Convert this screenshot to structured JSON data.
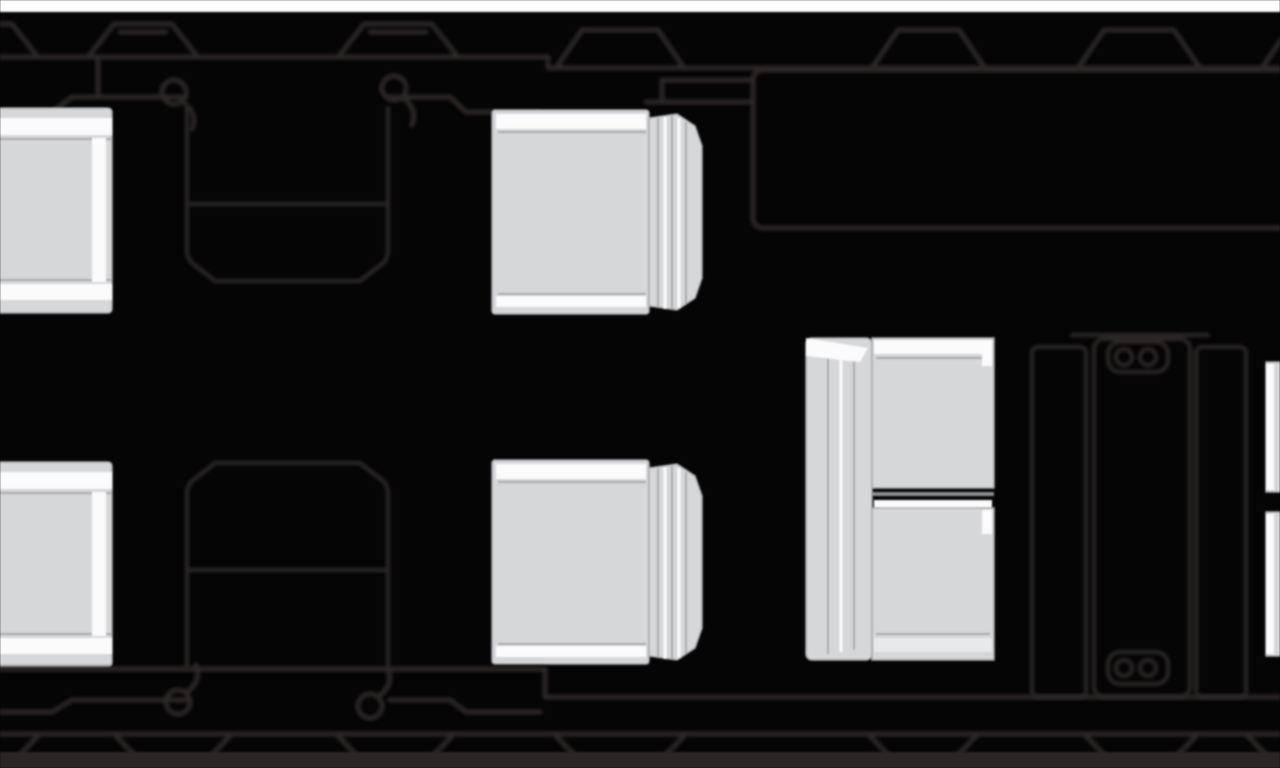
{
  "diagram": {
    "kind": "aircraft-cabin-floorplan-top-view",
    "visible_components": {
      "single_seats_left_wall": 2,
      "club_seats_center": 2,
      "divan_places": 2,
      "fold_out_tables": 2,
      "galley_compartment": 1,
      "cabinet_units": 3,
      "cupholder_pairs": 2,
      "door_latches_top": 2,
      "door_latches_bottom": 2,
      "windows_top_row": 7,
      "windows_bottom_row": 7,
      "partial_seat_right_edge": 1
    }
  },
  "colors": {
    "background": "#060505",
    "outline": "#2b2627",
    "seat_fill": "#d6d7d9",
    "seat_seam": "#a6a7aa",
    "highlight": "#fbfbfc",
    "page_strip_top": "#fdfdfd",
    "bottom_strip": "#2b2728",
    "divan_gap": "#8d8e91",
    "cushion_soft": "#e8e9ea"
  }
}
